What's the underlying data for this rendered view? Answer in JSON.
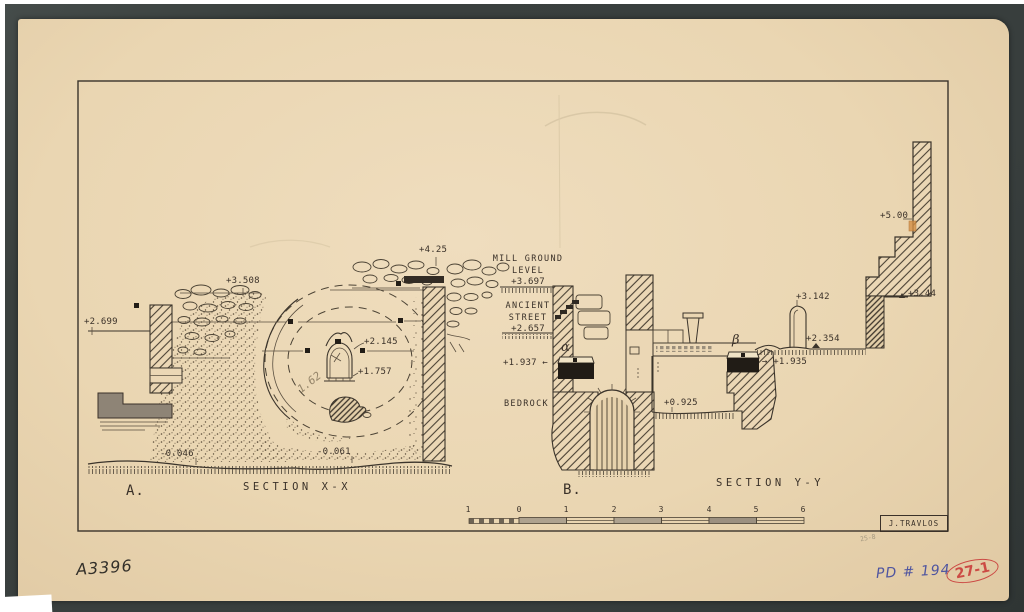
{
  "drawing": {
    "section_a": {
      "label": "A.",
      "title": "SECTION X-X",
      "levels": {
        "l2699": "+2.699",
        "l3508": "+3.508",
        "l425": "+4.25",
        "l2145": "+2.145",
        "l1757": "+1.757",
        "lm0046": "-0.046",
        "lm0061": "-0.061"
      },
      "pencil_measure": "1.62"
    },
    "section_b": {
      "label": "B.",
      "title": "SECTION Y-Y",
      "mill_ground_line1": "MILL GROUND",
      "mill_ground_line2": "LEVEL",
      "mill_ground_level": "+3.697",
      "ancient_street_line1": "ANCIENT",
      "ancient_street_line2": "STREET",
      "ancient_street_level": "+2.657",
      "bedrock": "BEDROCK",
      "alpha": "α",
      "beta": "β",
      "levels": {
        "l1937": "+1.937 ←",
        "l1935": "→ +1.935",
        "l0925": "+0.925",
        "l2354": "+2.354",
        "l3142": "+3.142",
        "l500": "+5.00",
        "l344": "+3.44"
      }
    },
    "scale_bar": {
      "ticks": [
        "1",
        "0",
        "1",
        "2",
        "3",
        "4",
        "5",
        "6"
      ]
    },
    "signature": "J.TRAVLOS"
  },
  "annotations": {
    "inventory_number": "A3396",
    "catalog_number": "PD # 194",
    "stamp_number": "27-1",
    "pencil_note": "25-8"
  },
  "colors": {
    "mat": "#3a403e",
    "paper": "#ead6b2",
    "ink": "#3b342b",
    "blue_ink": "#4f55a0",
    "red_ink": "#cc4a44"
  }
}
